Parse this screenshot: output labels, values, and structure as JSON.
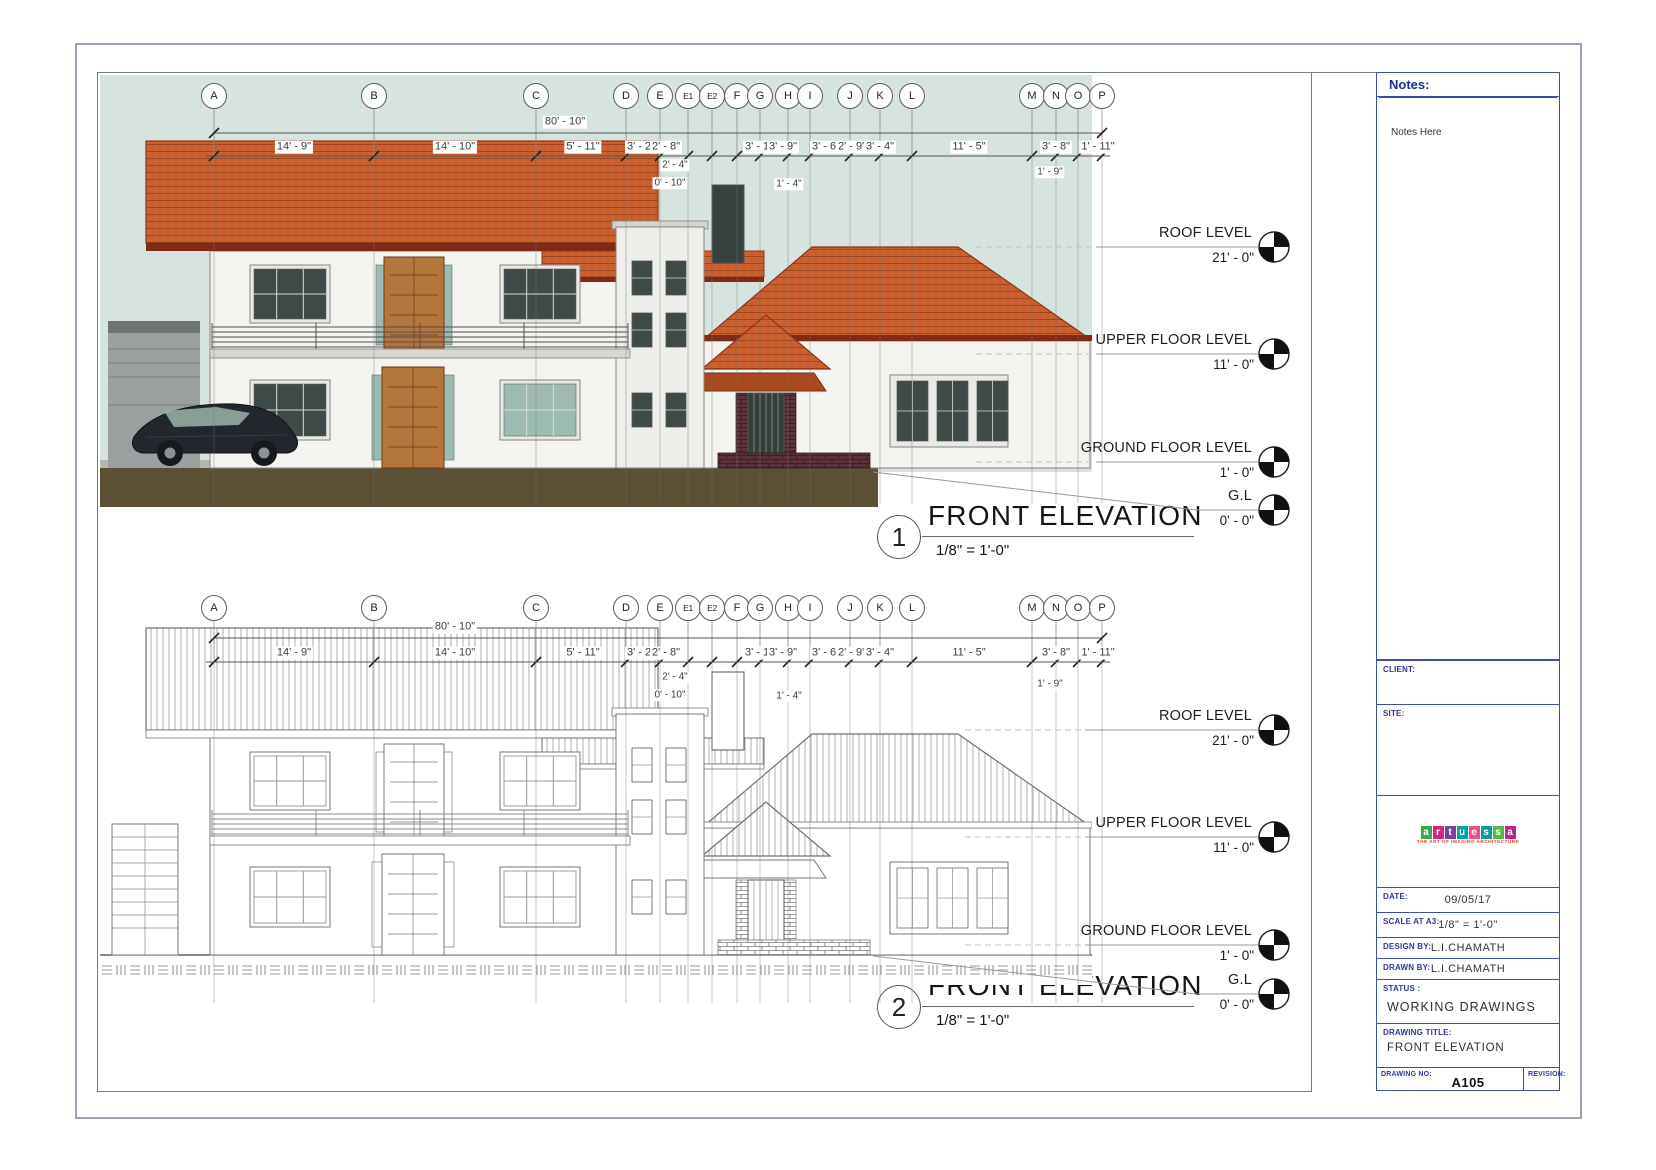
{
  "sheet": {
    "notes": {
      "header": "Notes:",
      "body": "Notes Here"
    },
    "grid_labels": [
      "A",
      "B",
      "C",
      "D",
      "E",
      "E1",
      "E2",
      "F",
      "G",
      "H",
      "I",
      "J",
      "K",
      "L",
      "M",
      "N",
      "O",
      "P"
    ],
    "dimensions": {
      "overall": "80' - 10\"",
      "segments": [
        "14' - 9\"",
        "14' - 10\"",
        "5' - 11\"",
        "3' - 2\"",
        "2' - 8\"",
        "3' - 1\"",
        "3' - 9\"",
        "3' - 6\"",
        "2' - 9\"",
        "3' - 4\"",
        "11' - 5\"",
        "3' - 8\"",
        "1' - 11\""
      ],
      "sub_dimensions": [
        "2' - 4\"",
        "0' - 10\"",
        "1' - 4\"",
        "1' - 9\""
      ]
    },
    "levels": [
      {
        "name": "ROOF LEVEL",
        "elevation": "21' - 0\""
      },
      {
        "name": "UPPER FLOOR LEVEL",
        "elevation": "11' - 0\""
      },
      {
        "name": "GROUND FLOOR LEVEL",
        "elevation": "1' - 0\""
      },
      {
        "name": "G.L",
        "elevation": "0' - 0\""
      }
    ],
    "views": [
      {
        "number": "1",
        "title": "FRONT ELEVATION",
        "scale": "1/8\" = 1'-0\""
      },
      {
        "number": "2",
        "title": "FRONT ELEVATION",
        "scale": "1/8\" = 1'-0\""
      }
    ],
    "titleblock": {
      "client_label": "CLIENT:",
      "site_label": "SITE:",
      "logo": {
        "word": [
          {
            "ch": "a",
            "bg": "#45a649"
          },
          {
            "ch": "r",
            "bg": "#d9218a"
          },
          {
            "ch": "t",
            "bg": "#7d3f9e"
          },
          {
            "ch": "u",
            "bg": "#00a3a3"
          },
          {
            "ch": "e",
            "bg": "#ea5190"
          },
          {
            "ch": "s",
            "bg": "#0d9e93"
          },
          {
            "ch": "s",
            "bg": "#55b84a"
          },
          {
            "ch": "a",
            "bg": "#c02383"
          }
        ],
        "tagline": "THE ART OF IMAGING ARCHITECTURE"
      },
      "date_label": "DATE:",
      "date_value": "09/05/17",
      "scale_label": "SCALE AT A3:",
      "scale_value": "1/8\" = 1'-0\"",
      "design_label": "DESIGN BY:",
      "design_value": "L.I.CHAMATH",
      "drawn_label": "DRAWN BY:",
      "drawn_value": "L.I.CHAMATH",
      "status_label": "STATUS :",
      "status_value": "WORKING DRAWINGS",
      "drawing_title_label": "DRAWING TITLE:",
      "drawing_title_value": "FRONT ELEVATION",
      "drawing_no_label": "DRAWING NO:",
      "drawing_no_value": "A105",
      "revision_label": "REVISION:"
    }
  }
}
